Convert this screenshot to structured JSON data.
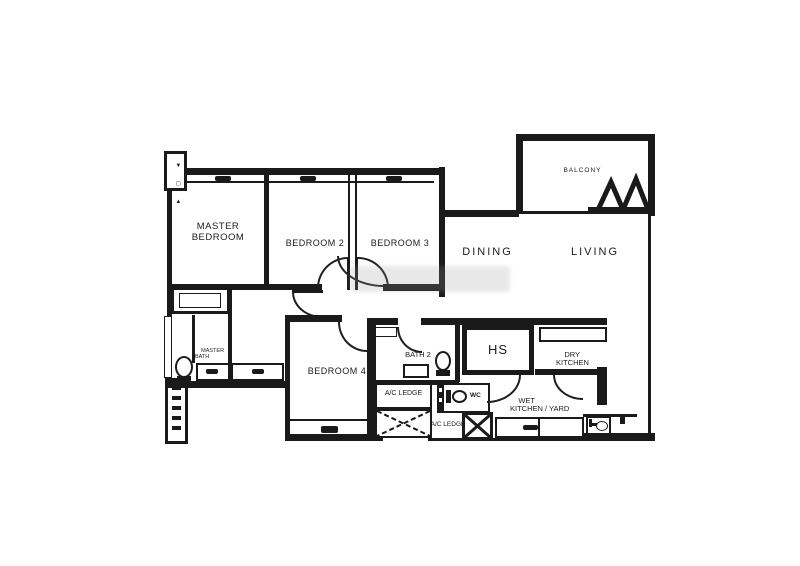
{
  "colors": {
    "wall": "#1a1a1a",
    "background": "#ffffff",
    "label": "#1c1c1c",
    "watermark": "#9a9a9a"
  },
  "rooms": {
    "master_bedroom": {
      "line1": "MASTER",
      "line2": "BEDROOM"
    },
    "bedroom2": {
      "label": "BEDROOM 2"
    },
    "bedroom3": {
      "label": "BEDROOM 3"
    },
    "bedroom4": {
      "label": "BEDROOM 4"
    },
    "dining": {
      "label": "DINING"
    },
    "living": {
      "label": "LIVING"
    },
    "balcony": {
      "label": "BALCONY"
    },
    "bath2": {
      "label": "BATH 2"
    },
    "master_bath": {
      "line1": "MASTER",
      "line2": "BATH"
    },
    "hs": {
      "label": "HS"
    },
    "dry_kitchen": {
      "line1": "DRY",
      "line2": "KITCHEN"
    },
    "wet_kitchen": {
      "line1": "WET",
      "line2": "KITCHEN / YARD"
    },
    "ac_ledge_left": {
      "label": "A/C LEDGE"
    },
    "ac_ledge_bottom": {
      "label": "A/C LEDGE"
    },
    "wc": {
      "label": "WC"
    }
  },
  "icons": {
    "shaft_top": {
      "g1": "▼",
      "g2": "◻",
      "g3": "▲"
    }
  }
}
